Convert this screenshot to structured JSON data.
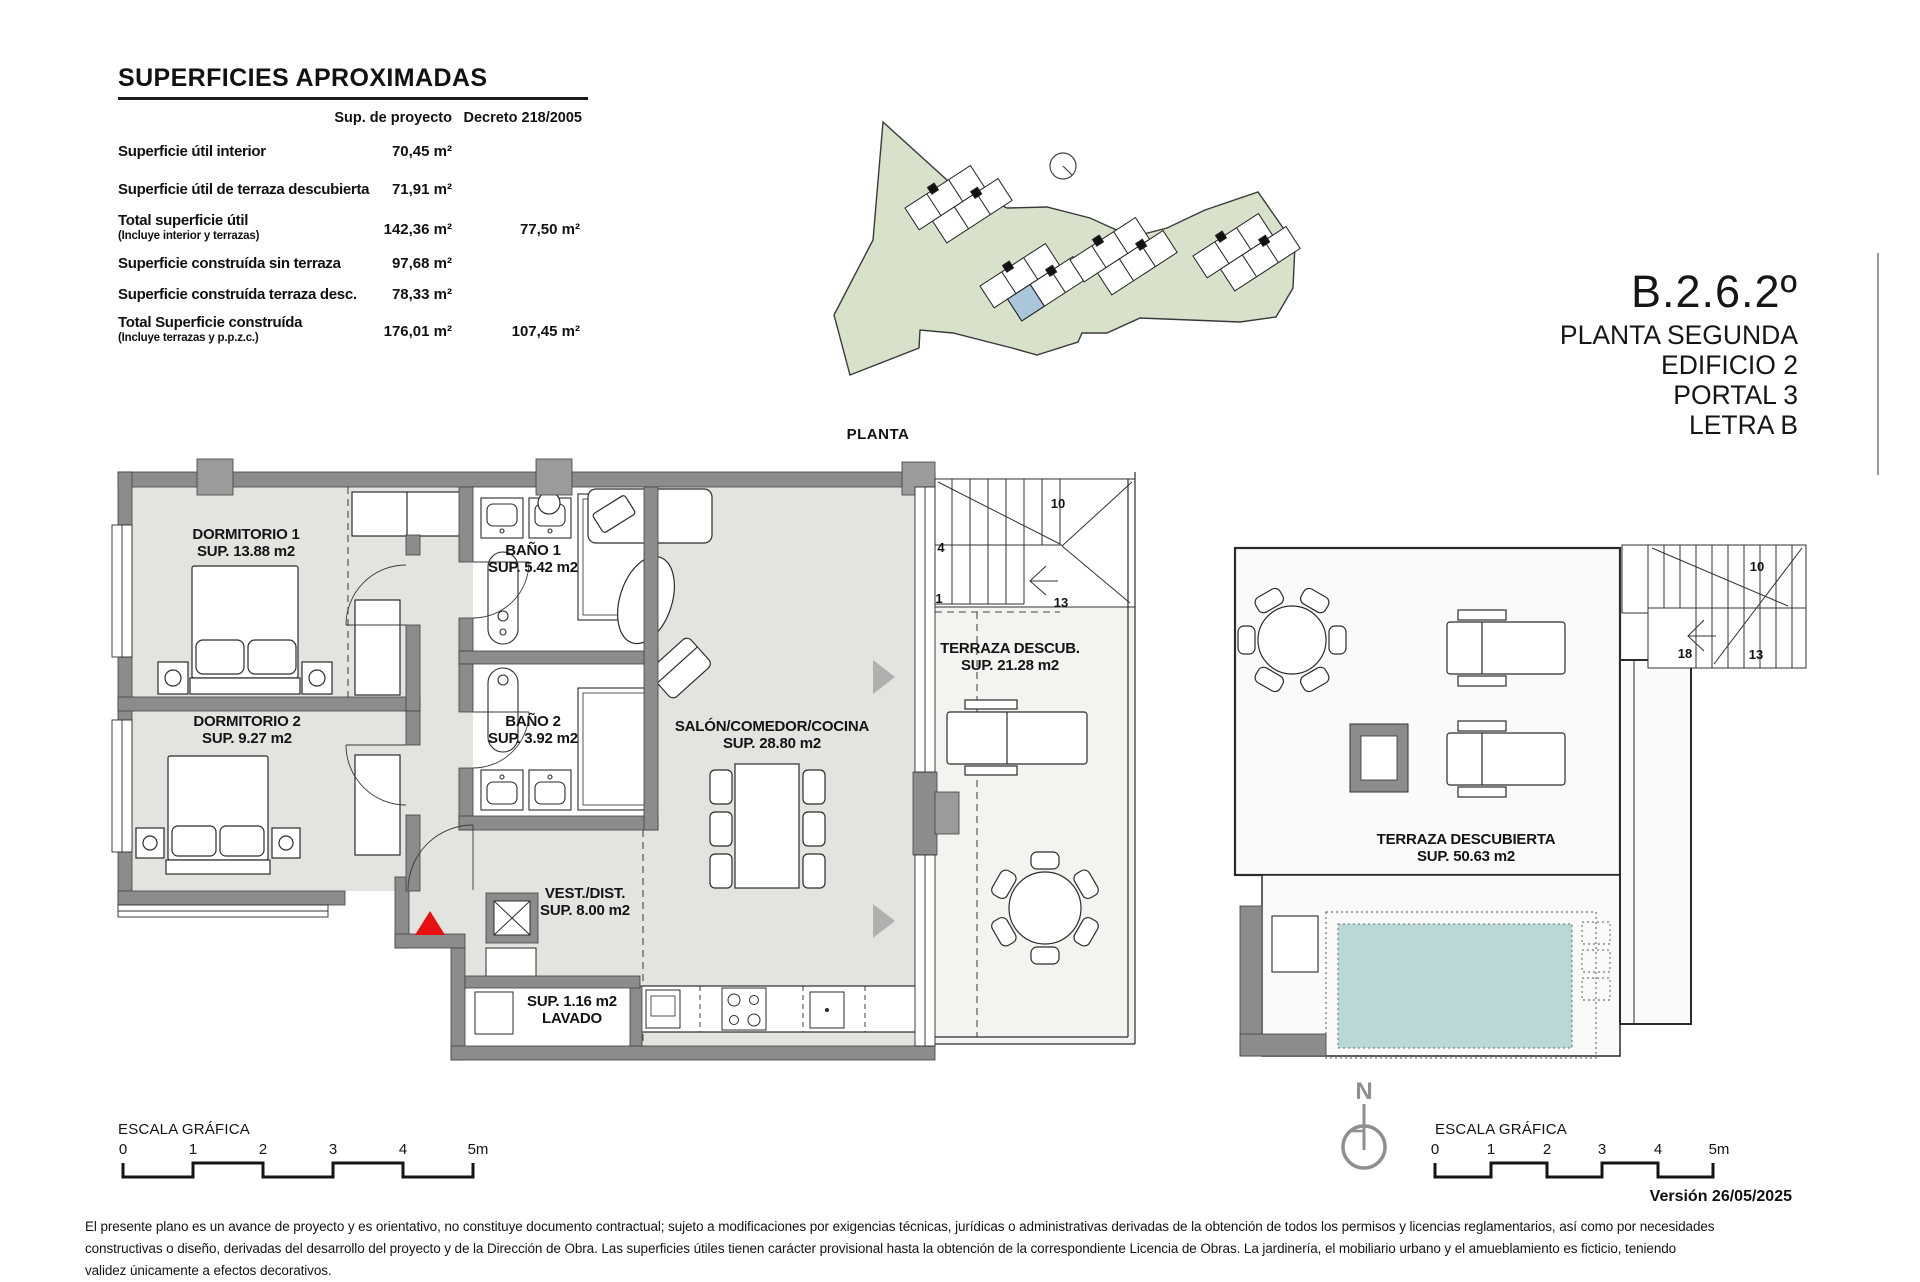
{
  "colors": {
    "site_green": "#d8e1ca",
    "floor_gray": "#e3e3df",
    "wall_gray": "#8c8c8c",
    "pool_blue": "#b9d8d6",
    "unit_highlight_blue": "#a9c6da",
    "entrance_red": "#e81010"
  },
  "areas_table": {
    "title": "SUPERFICIES APROXIMADAS",
    "col_proyecto": "Sup. de proyecto",
    "col_decreto": "Decreto 218/2005",
    "rows": [
      {
        "label": "Superficie útil interior",
        "note": "",
        "proyecto": "70,45  m²",
        "decreto": ""
      },
      {
        "label": "Superficie útil de terraza descubierta",
        "note": "",
        "proyecto": "71,91  m²",
        "decreto": ""
      },
      {
        "label": "Total superficie útil",
        "note": "(Incluye interior y terrazas)",
        "proyecto": "142,36  m²",
        "decreto": "77,50  m²"
      },
      {
        "label": "Superficie construída sin terraza",
        "note": "",
        "proyecto": "97,68  m²",
        "decreto": ""
      },
      {
        "label": "Superficie construída terraza desc.",
        "note": "",
        "proyecto": "78,33  m²",
        "decreto": ""
      },
      {
        "label": "Total Superficie construída",
        "note": "(Incluye terrazas y p.p.z.c.)",
        "proyecto": "176,01  m²",
        "decreto": "107,45  m²"
      }
    ]
  },
  "site_plan": {
    "label": "PLANTA"
  },
  "unit_block": {
    "code": "B.2.6.2º",
    "line1": "PLANTA SEGUNDA",
    "line2": "EDIFICIO 2",
    "line3": "PORTAL  3",
    "line4": "LETRA B"
  },
  "rooms": {
    "dorm1": {
      "name": "DORMITORIO 1",
      "area": "SUP. 13.88 m2"
    },
    "bano1": {
      "name": "BAÑO 1",
      "area": "SUP. 5.42 m2"
    },
    "dorm2": {
      "name": "DORMITORIO 2",
      "area": "SUP. 9.27 m2"
    },
    "bano2": {
      "name": "BAÑO 2",
      "area": "SUP. 3.92 m2"
    },
    "salon": {
      "name": "SALÓN/COMEDOR/COCINA",
      "area": "SUP. 28.80 m2"
    },
    "vest": {
      "name": "VEST./DIST.",
      "area": "SUP. 8.00 m2"
    },
    "terraza": {
      "name": "TERRAZA DESCUB.",
      "area": "SUP. 21.28 m2"
    },
    "lavado": {
      "area": "SUP. 1.16 m2",
      "name": "LAVADO"
    },
    "terraza_solarium": {
      "name": "TERRAZA DESCUBIERTA",
      "area": "SUP. 50.63 m2"
    }
  },
  "stairs_apartment": {
    "n_top": "10",
    "n_mid": "4",
    "n_low": "1",
    "n_low_right": "13"
  },
  "stairs_solarium": {
    "n_top": "10",
    "n_left": "18",
    "n_right": "13"
  },
  "scale_bar": {
    "label": "ESCALA GRÁFICA",
    "ticks": [
      "0",
      "1",
      "2",
      "3",
      "4",
      "5m"
    ]
  },
  "north": {
    "label": "N"
  },
  "footer": {
    "version": "Versión 26/05/2025",
    "disclaimer": [
      "El presente plano es un avance de proyecto y es orientativo, no constituye documento contractual; sujeto a modificaciones por exigencias técnicas, jurídicas o administrativas derivadas de la obtención de todos los permisos y licencias reglamentarios, así como por necesidades",
      "constructivas o diseño, derivadas del desarrollo del proyecto y de la Dirección de Obra. Las superficies útiles tienen carácter provisional hasta la obtención de la correspondiente Licencia de Obras. La jardinería, el mobiliario urbano y el amueblamiento es ficticio, teniendo",
      "validez únicamente a efectos decorativos."
    ]
  }
}
